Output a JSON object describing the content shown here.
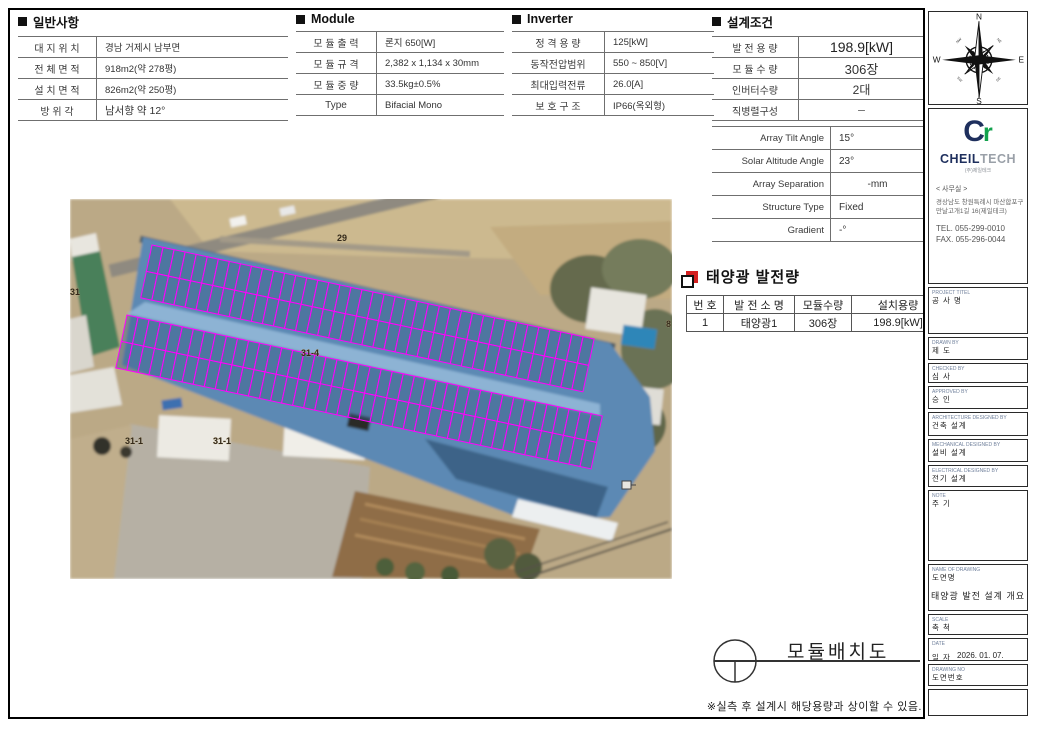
{
  "general": {
    "title": "일반사항",
    "rows": [
      {
        "label": "대 지 위 치",
        "value": "경남 거제시 남부면"
      },
      {
        "label": "전 체 면 적",
        "value": "918m2(약 278평)"
      },
      {
        "label": "설 치 면 적",
        "value": "826m2(약 250평)"
      },
      {
        "label": "방  위  각",
        "value": "남서향 약 12°"
      }
    ]
  },
  "module": {
    "title": "Module",
    "rows": [
      {
        "label": "모 듈 출 력",
        "value": "론지 650[W]"
      },
      {
        "label": "모 듈 규 격",
        "value": "2,382 x 1,134 x 30mm"
      },
      {
        "label": "모 듈 중 량",
        "value": "33.5kg±0.5%"
      },
      {
        "label": "Type",
        "value": "Bifacial Mono"
      }
    ]
  },
  "inverter": {
    "title": "Inverter",
    "rows": [
      {
        "label": "정 격 용 량",
        "value": "125[kW]"
      },
      {
        "label": "동작전압범위",
        "value": "550 ~ 850[V]"
      },
      {
        "label": "최대입력전류",
        "value": "26.0[A]"
      },
      {
        "label": "보 호 구 조",
        "value": "IP66(옥외형)"
      }
    ]
  },
  "design": {
    "title": "설계조건",
    "rows_kr": [
      {
        "label": "발 전 용 량",
        "value": "198.9[kW]"
      },
      {
        "label": "모 듈 수 량",
        "value": "306장"
      },
      {
        "label": "인버터수량",
        "value": "2대"
      },
      {
        "label": "직병렬구성",
        "value": "－"
      }
    ],
    "rows_en": [
      {
        "label": "Array Tilt Angle",
        "value": "15°"
      },
      {
        "label": "Solar Altitude Angle",
        "value": "23°"
      },
      {
        "label": "Array Separation",
        "value": "-mm"
      },
      {
        "label": "Structure Type",
        "value": "Fixed"
      },
      {
        "label": "Gradient",
        "value": "-°"
      }
    ]
  },
  "generation": {
    "title": "태양광 발전량",
    "headers": [
      "번 호",
      "발 전 소 명",
      "모듈수량",
      "설치용량"
    ],
    "rows": [
      [
        "1",
        "태양광1",
        "306장",
        "198.9[kW]"
      ]
    ]
  },
  "layout": {
    "title": "모듈배치도"
  },
  "footnote": "※실측 후 설계시 해당용량과 상이할 수 있음.",
  "compass": {
    "n": "N",
    "e": "E",
    "s": "S",
    "w": "W",
    "ne": "NE",
    "se": "SE",
    "sw": "SW",
    "nw": "NW"
  },
  "company": {
    "mark_c": "C",
    "mark_r": "r",
    "name_bold": "CHEIL",
    "name_light": "TECH",
    "sub": "(주)제일테크",
    "office_label": "< 사무실 >",
    "address1": "경상남도 창원특례시 마산합포구",
    "address2": "만날고개1길 16(제일테크)",
    "tel": "TEL. 055-299-0010",
    "fax": "FAX. 055-296-0044"
  },
  "titleblock": {
    "fields": [
      {
        "en": "PROJECT TITEL",
        "kr": "공 사 명",
        "value": ""
      },
      {
        "en": "DRAWN BY",
        "kr": "제  도",
        "value": ""
      },
      {
        "en": "CHECKED BY",
        "kr": "심  사",
        "value": ""
      },
      {
        "en": "APPROVED BY",
        "kr": "승  인",
        "value": ""
      },
      {
        "en": "ARCHITECTURE DESIGNED BY",
        "kr": "건축 설계",
        "value": ""
      },
      {
        "en": "MECHANICAL DESIGNED BY",
        "kr": "설비 설계",
        "value": ""
      },
      {
        "en": "ELECTRICAL DESIGNED BY",
        "kr": "전기 설계",
        "value": ""
      },
      {
        "en": "NOTE",
        "kr": "주  기",
        "value": ""
      },
      {
        "en": "NAME OF DRAWING",
        "kr": "도면명",
        "value": "태양광 발전 설계 개요"
      },
      {
        "en": "SCALE",
        "kr": "축  척",
        "value": ""
      },
      {
        "en": "DATE",
        "kr": "일  자",
        "value": "2026. 01. 07."
      },
      {
        "en": "DRAWING NO",
        "kr": "도면번호",
        "value": ""
      }
    ]
  },
  "map": {
    "labels": [
      {
        "text": "29",
        "x": 267,
        "y": 42
      },
      {
        "text": "31",
        "x": 0,
        "y": 96
      },
      {
        "text": "31-4",
        "x": 231,
        "y": 157
      },
      {
        "text": "31-1",
        "x": 55,
        "y": 245
      },
      {
        "text": "31-1",
        "x": 143,
        "y": 245
      },
      {
        "text": "8",
        "x": 596,
        "y": 128
      }
    ],
    "bands": [
      {
        "x": 82,
        "y": 46,
        "cols": 40,
        "rows": 2,
        "cellW": 11.3,
        "cellH": 27,
        "angle": 12
      },
      {
        "x": 57,
        "y": 116,
        "cols": 43,
        "rows": 2,
        "cellW": 11.3,
        "cellH": 27,
        "angle": 12
      }
    ],
    "colors": {
      "panel_line": "#ff00ff",
      "panel_fill": "#3e5f87",
      "roof": "#5b89b4",
      "roof_light": "#8db3d4",
      "roof_dark": "#3d6388"
    }
  }
}
